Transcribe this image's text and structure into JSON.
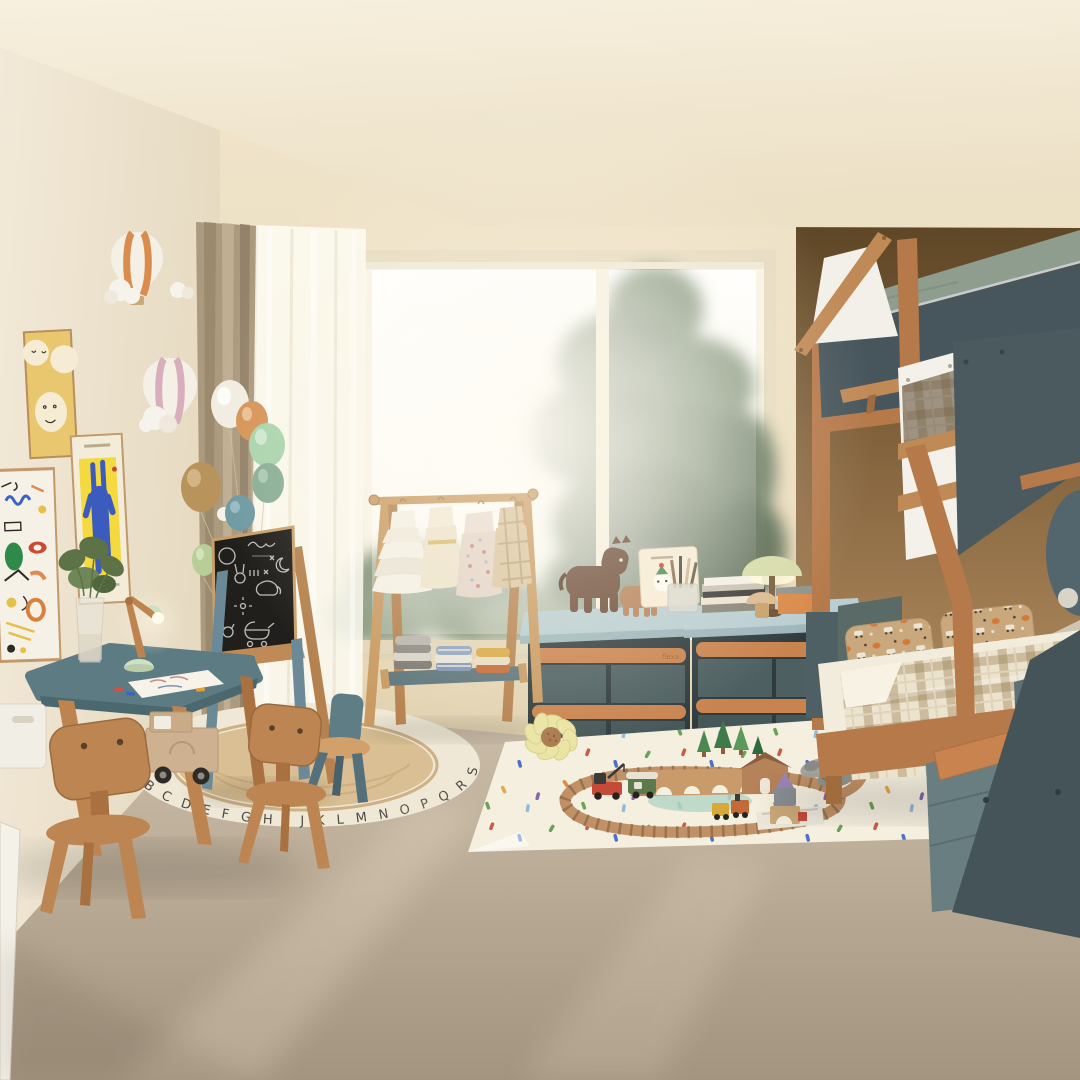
{
  "scene": {
    "type": "interior-render",
    "room": "kids-bedroom",
    "lighting": "soft daylight through large window",
    "view": "wide corner view"
  },
  "palette": {
    "ceiling": "#f5eedc",
    "back_wall": "#ece0c6",
    "left_wall": "#f0e7d5",
    "alcove_wall": "#8a6a44",
    "floor": "#b5a794",
    "accent_teal": "#5d7b83",
    "bin_slate": "#4d5f61",
    "wood": "#c08a57",
    "rail_wood": "#c9834f",
    "mattress_green": "#8e9d8e",
    "plaid_bedding": "#cdbb9d",
    "rug_cream": "#f5efdf",
    "chalkboard": "#211f1c"
  },
  "window": {
    "panes": 2,
    "view": "pine trees",
    "frame": "#efe6cf"
  },
  "curtains": {
    "left_drape": "tan",
    "right_sheer": "white"
  },
  "wall_art": {
    "posters": [
      {
        "name": "smiley-poster",
        "bg": "#e9c76f"
      },
      {
        "name": "doodle-poster",
        "bg": "#f6f1e6"
      },
      {
        "name": "rabbit-poster",
        "bg": "#f4d93f",
        "figure": "#3b5bbf"
      }
    ],
    "decor": [
      "hot-air-balloon-orange",
      "hot-air-balloon-pink",
      "clouds",
      "white-balloon"
    ]
  },
  "balloons": {
    "colors": [
      "#f1ede2",
      "#d69457",
      "#a9d4ad",
      "#89ae95",
      "#b8935c",
      "#6f9ba3",
      "#b7cf97"
    ]
  },
  "easel": {
    "surface": "chalkboard",
    "chalk_doodles": [
      "sun",
      "bunny",
      "elephant",
      "moon",
      "stars",
      "pram",
      "cat",
      "scribbles"
    ]
  },
  "clothes_rack": {
    "garments": [
      "white ruffle dress",
      "cream dress",
      "floral dress",
      "plaid dress"
    ],
    "shelf_stacks": [
      "grey knits",
      "blue stripe shirts",
      "mustard & rust sweaters"
    ]
  },
  "storage": {
    "units": 2,
    "bins_per_unit": 4,
    "brand_label": "flexa",
    "top_items": [
      "dark plush horse",
      "tan plush horse",
      "standing card",
      "brush cup",
      "book stack",
      "green table lamp",
      "wooden mushroom",
      "orange box"
    ]
  },
  "table_set": {
    "table_top_color": "#5d7b83",
    "chairs": 3,
    "items": [
      "glass vase with greenery",
      "wooden task lamp",
      "drawing paper",
      "crayons"
    ]
  },
  "alphabet_rug": {
    "letters": "A B C D E F G H I J K L M N O P Q R S T U V W X Y Z"
  },
  "bunk_bed": {
    "style": "house frame bunk",
    "panel_color": "#4b5a5f",
    "bedding": "beige gingham duvet",
    "pillows": 2,
    "stair_steps": 2
  },
  "play_rug": {
    "pattern": "confetti dots",
    "toys": [
      "wooden train loop",
      "arch bridge",
      "crane truck",
      "green engine",
      "yellow train",
      "pine trees",
      "toy house",
      "block tower"
    ],
    "slippers": "grey"
  }
}
